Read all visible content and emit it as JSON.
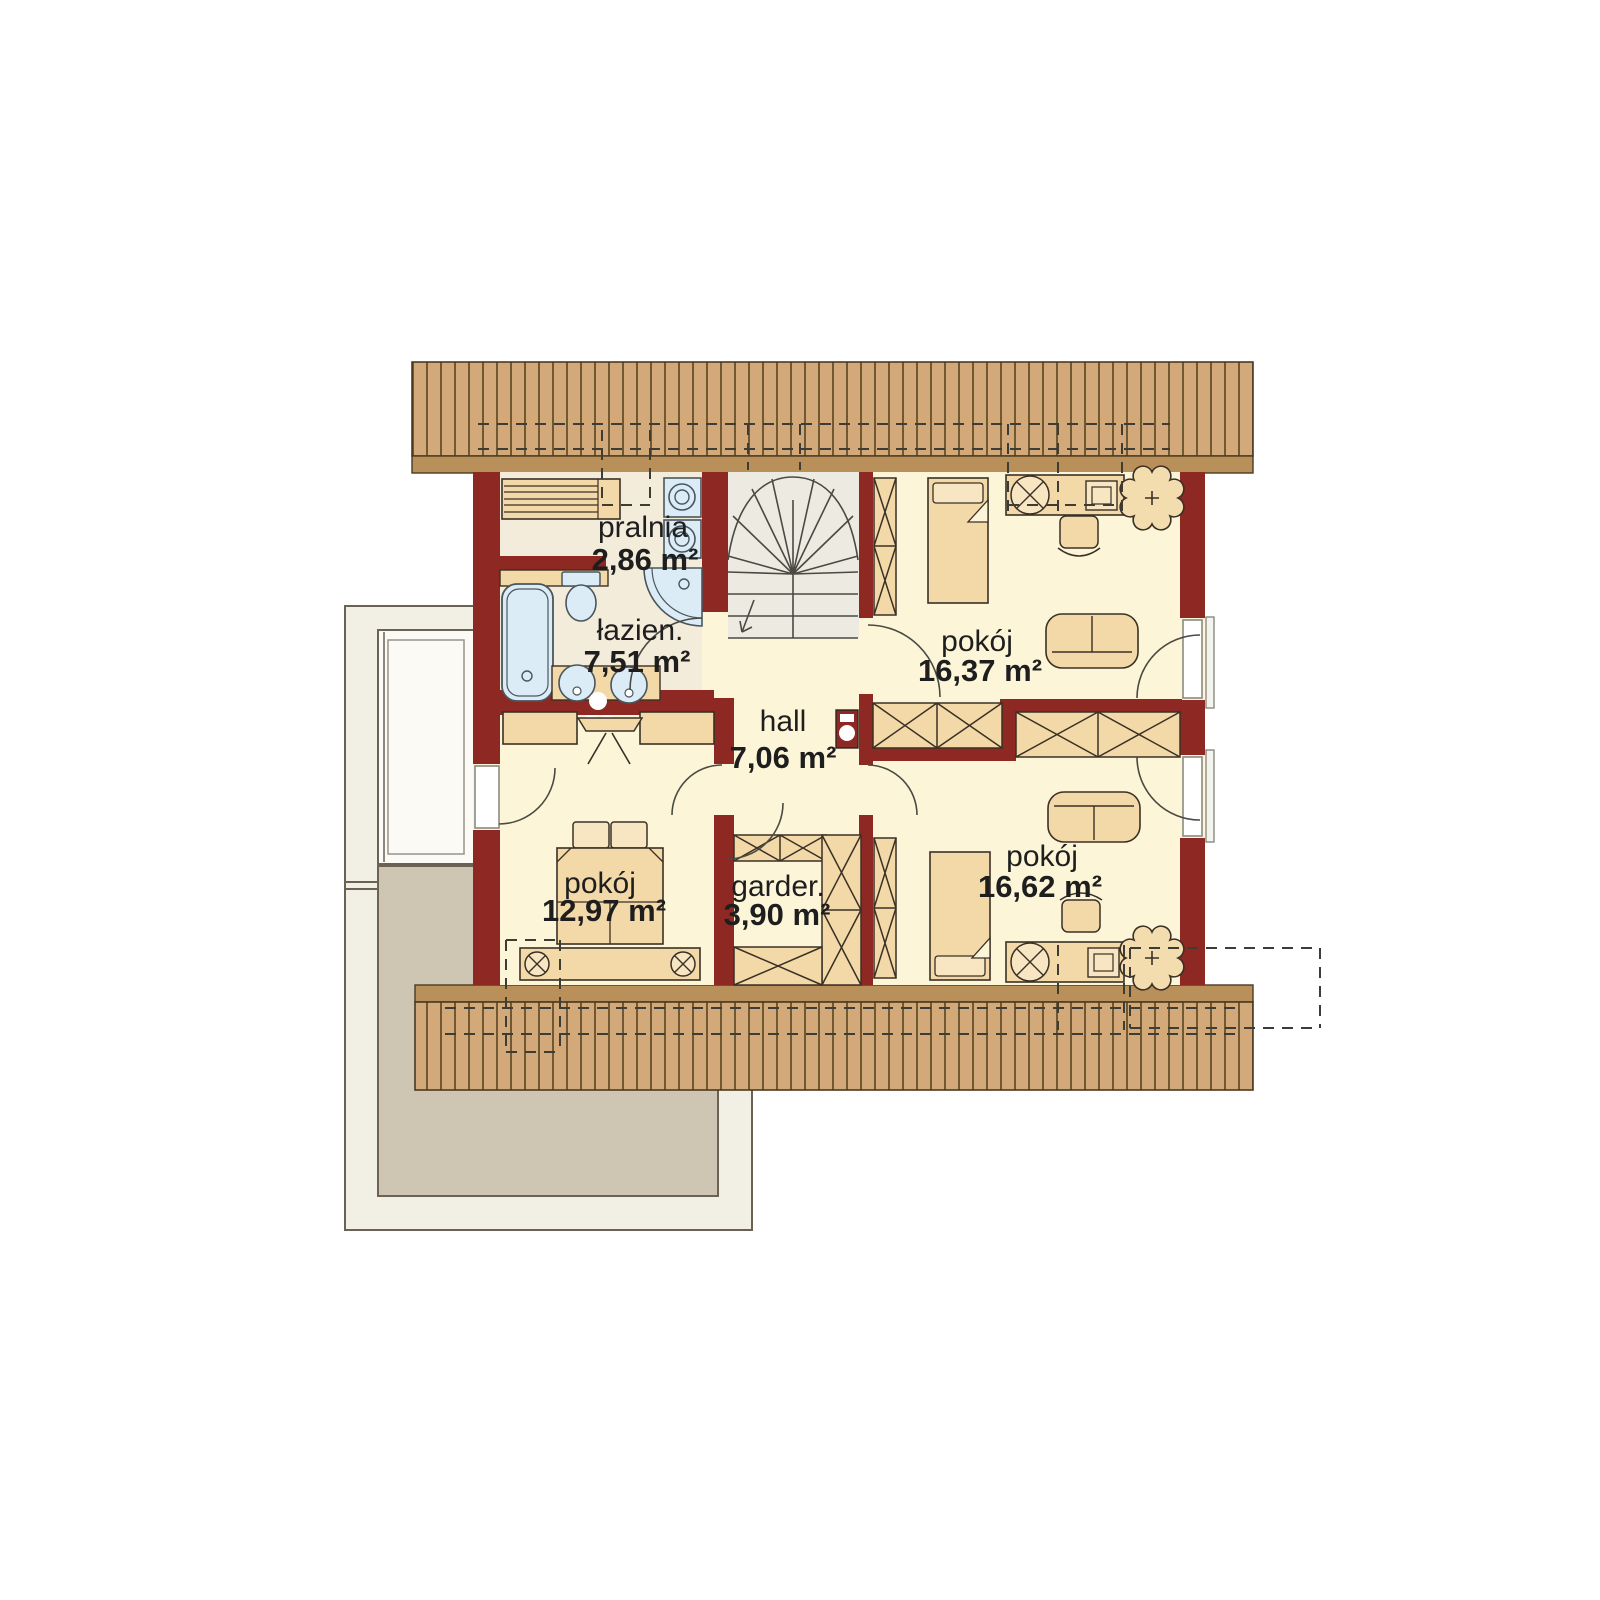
{
  "plan": {
    "kind": "attic-floor-plan",
    "language": "pl"
  },
  "rooms": [
    {
      "key": "pralnia",
      "name": "pralnia",
      "area": "2,86 m²"
    },
    {
      "key": "lazienka",
      "name": "łazien.",
      "area": "7,51 m²"
    },
    {
      "key": "hall",
      "name": "hall",
      "area": "7,06 m²"
    },
    {
      "key": "pokoj-polnocny",
      "name": "pokój",
      "area": "16,37 m²"
    },
    {
      "key": "sypialnia",
      "name": "pokój",
      "area": "12,97 m²"
    },
    {
      "key": "garderoba",
      "name": "garder.",
      "area": "3,90 m²"
    },
    {
      "key": "pokoj-poludniowy",
      "name": "pokój",
      "area": "16,62 m²"
    }
  ],
  "colors": {
    "wall": "#8d2823",
    "roof_hatch": "#d4a97a",
    "roof_edge": "#b9905a",
    "roof_line": "#57431f",
    "floor": "#fcf5d8",
    "floor_bath": "#f4ecda",
    "floor_stairs": "#edeae1",
    "furniture": "#f3d9a7",
    "furniture_light": "#f8e6c2",
    "fixture_blue": "#dcecf6",
    "terrace_light": "#f2efe4",
    "terrace_dark": "#cec5b3",
    "outline": "#3a3026",
    "text": "#1e1e1e"
  },
  "symbols": [
    "stairs",
    "bathtub",
    "toilet",
    "corner-shower",
    "washbasin",
    "washing-machine",
    "drying-rack",
    "double-bed",
    "single-bed",
    "wardrobe",
    "desk",
    "desk-chair",
    "sofa",
    "plant",
    "ceiling-lamp",
    "mirror",
    "dressing-table",
    "balcony-door",
    "interior-door",
    "balcony-rail",
    "terrace"
  ]
}
